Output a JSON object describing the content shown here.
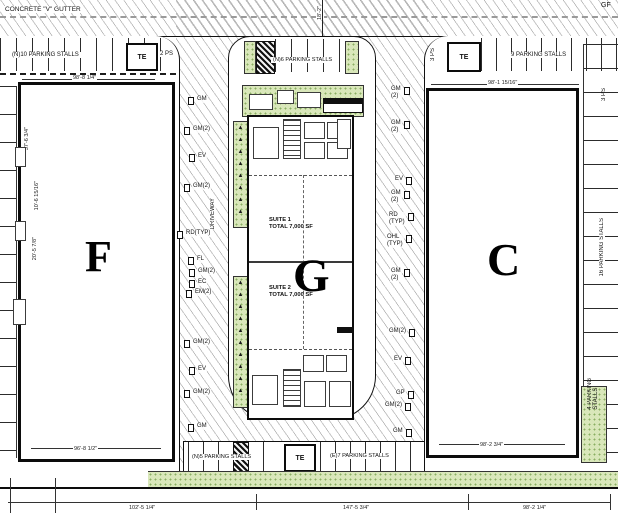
{
  "street": {
    "gutter": "CONCRETE \"V\" GUTTER",
    "corner": "GF",
    "vdim": "18'-2\""
  },
  "buildings": {
    "f": "F",
    "g": "G",
    "c": "C"
  },
  "suite1": {
    "text": "SUITE 1\nTOTAL 7,000 SF"
  },
  "suite2": {
    "text": "SUITE 2\nTOTAL 7,000 SF"
  },
  "parking": {
    "top_left": "(N)10 PARKING STALLS",
    "two_ps": "2 PS",
    "top_mid": "(N)6 PARKING STALLS",
    "top_right": "9 PARKING STALLS",
    "three_ps_left": "3 PS",
    "three_ps_right": "3 PS",
    "right_mid": "16 PARKING STALLS",
    "right_bottom": "4 PARKING\nSTALLS",
    "bottom_left": "(N)5 PARKING STALLS",
    "bottom_right": "(E)7 PARKING STALLS",
    "te": "TE"
  },
  "labels": {
    "driveway": "DRIVEWAY"
  },
  "dims": {
    "f_top": "98'-8 1/4\"",
    "c_top": "98'-1 15/16\"",
    "f_bottom": "96'-8 1/2\"",
    "c_bottom": "98'-2 3/4\"",
    "bot_left": "102'-5 1/4\"",
    "bot_mid": "147'-5 3/4\"",
    "bot_right": "98'-2 1/4\"",
    "f_left": [
      "37'-6 3/4\"",
      "10'-6 15/16\"",
      "20'-5 7/8\""
    ]
  },
  "callouts": {
    "left": [
      {
        "x": 196,
        "y": 96,
        "t": "GM"
      },
      {
        "x": 192,
        "y": 126,
        "t": "GM(2)"
      },
      {
        "x": 197,
        "y": 153,
        "t": "EV"
      },
      {
        "x": 192,
        "y": 183,
        "t": "GM(2)"
      },
      {
        "x": 185,
        "y": 230,
        "t": "RD(TYP)"
      },
      {
        "x": 196,
        "y": 256,
        "t": "FL"
      },
      {
        "x": 197,
        "y": 268,
        "t": "GM(2)"
      },
      {
        "x": 197,
        "y": 279,
        "t": "EC"
      },
      {
        "x": 194,
        "y": 289,
        "t": "EM(2)"
      },
      {
        "x": 192,
        "y": 339,
        "t": "GM(2)"
      },
      {
        "x": 197,
        "y": 366,
        "t": "EV"
      },
      {
        "x": 192,
        "y": 389,
        "t": "GM(2)"
      },
      {
        "x": 196,
        "y": 423,
        "t": "GM"
      }
    ],
    "right": [
      {
        "x": 390,
        "y": 86,
        "t": "GM\n(2)"
      },
      {
        "x": 390,
        "y": 120,
        "t": "GM\n(2)"
      },
      {
        "x": 394,
        "y": 176,
        "t": "EV"
      },
      {
        "x": 390,
        "y": 190,
        "t": "GM\n(2)"
      },
      {
        "x": 388,
        "y": 212,
        "t": "RD\n(TYP)"
      },
      {
        "x": 386,
        "y": 234,
        "t": "OHL\n(TYP)"
      },
      {
        "x": 390,
        "y": 268,
        "t": "GM\n(2)"
      },
      {
        "x": 388,
        "y": 328,
        "t": "GM(2)"
      },
      {
        "x": 393,
        "y": 356,
        "t": "EV"
      },
      {
        "x": 395,
        "y": 390,
        "t": "GP"
      },
      {
        "x": 384,
        "y": 402,
        "t": "GM(2)"
      },
      {
        "x": 392,
        "y": 428,
        "t": "GM"
      }
    ]
  }
}
